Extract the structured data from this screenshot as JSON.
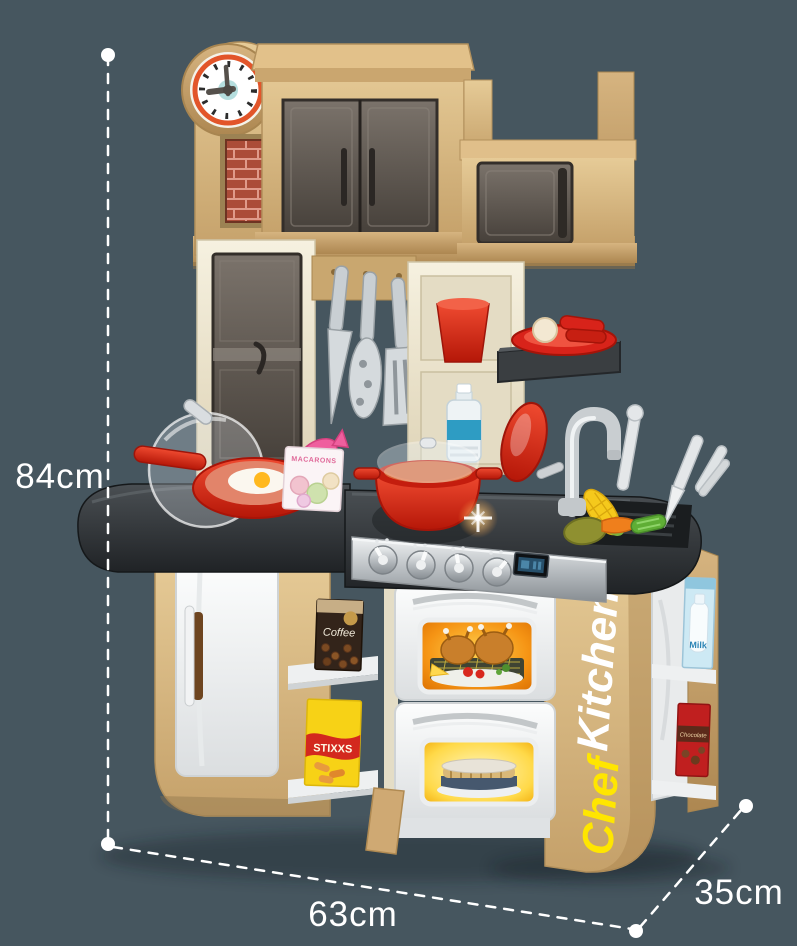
{
  "scene": {
    "description": "Toy kitchen playset product photo with dimension annotations",
    "background_color": "#46565f"
  },
  "dimensions": {
    "height": "84cm",
    "width": "63cm",
    "depth": "35cm"
  },
  "branding": {
    "word1": "Chef",
    "word2": "Kitchen",
    "word1_color": "#ffe600",
    "word2_color": "#ffffff"
  },
  "boxes": {
    "coffee": "Coffee",
    "snack": "STIXXS",
    "macarons": "MACARONS",
    "milk": "Milk",
    "chocolate": "Chocolate"
  },
  "colors": {
    "cabinet_tan": "#d8b987",
    "cream": "#efe8d4",
    "smoke_door": "#5d564f",
    "countertop": "#2b2e30",
    "accent_red": "#d92a1a",
    "steel": "#c7cbce",
    "brick": "#ab4c38",
    "annotation": "#ffffff"
  }
}
